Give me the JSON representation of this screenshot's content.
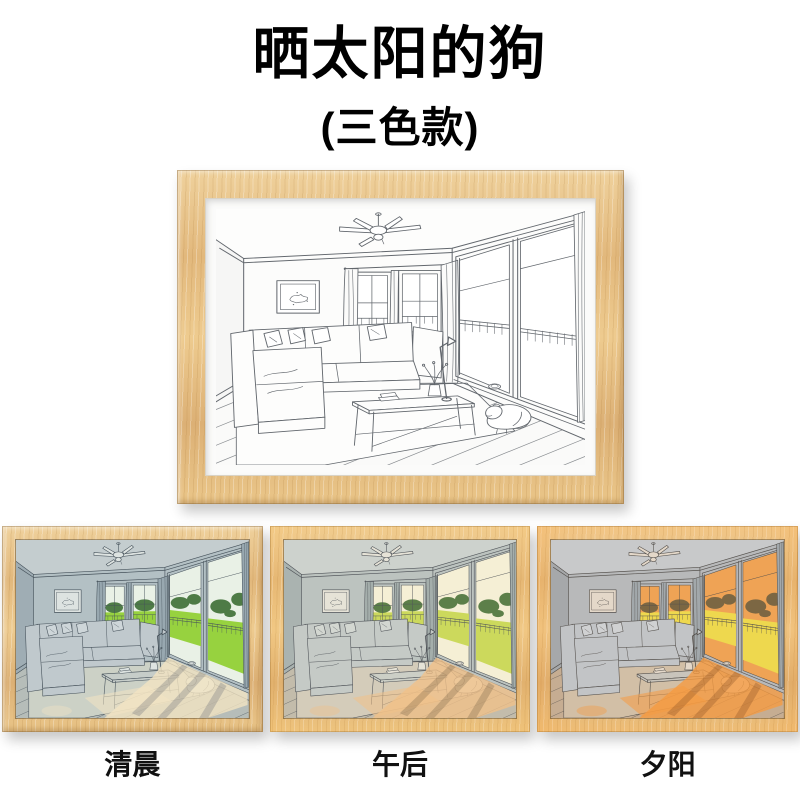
{
  "title": "晒太阳的狗",
  "subtitle": "(三色款)",
  "artwork_alt": "line drawing of a living room with sectional sofa, coffee table, ceiling fan, large windows and a dog sleeping in the sunlight",
  "variants": [
    {
      "label": "清晨",
      "accent": "#97d23f"
    },
    {
      "label": "午后",
      "accent": "#f0c189"
    },
    {
      "label": "夕阳",
      "accent": "#f59b42"
    }
  ],
  "colors": {
    "page_background": "#ffffff",
    "title_text": "#000000",
    "frame_wood": "#e6c188"
  }
}
